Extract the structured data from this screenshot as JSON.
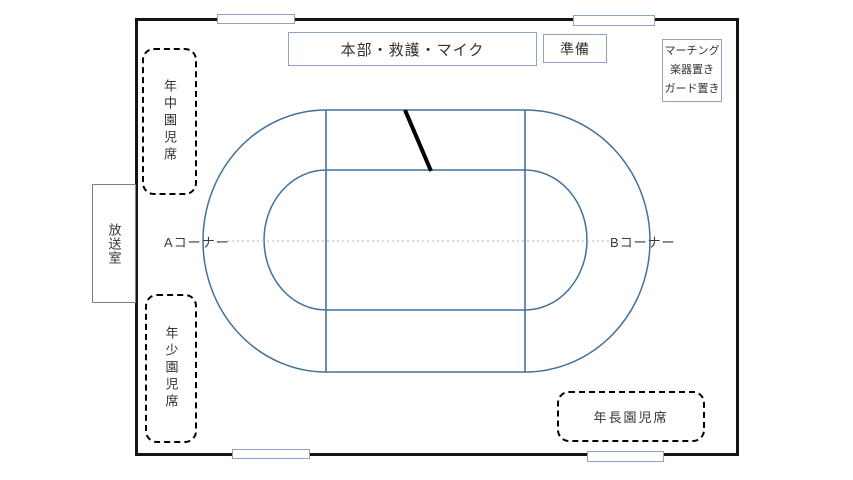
{
  "colors": {
    "field-border": "#141414",
    "track-line": "#41719C",
    "box-border": "#8ea3c6",
    "broadcast-border": "#7f7f7f",
    "dashed-border": "#000000",
    "center-line": "#a3b5d2",
    "start-line": "#000000"
  },
  "top_boxes": {
    "headquarters": "本部・救護・マイク",
    "preparation": "準備",
    "marching": {
      "line1": "マーチング",
      "line2": "楽器置き",
      "line3": "ガード置き"
    }
  },
  "rooms": {
    "broadcast": "放送室"
  },
  "seats": {
    "middle": "年中園児席",
    "young": "年少園児席",
    "senior": "年長園児席"
  },
  "track": {
    "corner_a": "Aコーナー",
    "corner_b": "Bコーナー"
  }
}
